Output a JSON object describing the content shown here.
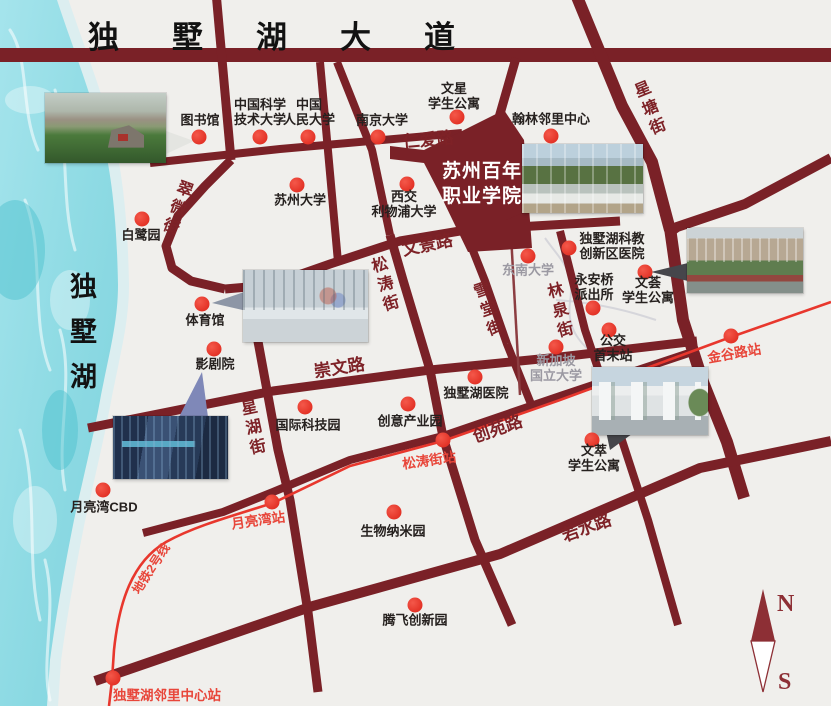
{
  "map": {
    "title": "苏州百年职业学院周边交通示意图",
    "colors": {
      "background": "#f0efec",
      "road": "#7a2127",
      "road_minor": "#8c3d41",
      "metro": "#e8372d",
      "dot": "#dc2318",
      "station_text": "#e8463a",
      "road_label_text": "#7e2227",
      "poi_text": "#26211f",
      "poi_text_gray": "#9b99a2",
      "lake_water": "#8fdbe4",
      "lake_shore": "#dceef0",
      "compass": "#8d2f35"
    },
    "avenue": {
      "text": "独墅湖大道"
    },
    "lake": {
      "label": "独墅湖",
      "halo_path": "M57,0 C70,40 90,90 103,140 C113,180 117,230 118,285 C118,320 110,350 101,395 C95,430 85,470 74,520 C65,565 56,615 50,660 L47,706",
      "water_path": "M57,0 C70,40 90,90 103,140 C113,180 117,230 118,285 C118,320 110,350 101,395 C95,430 85,470 74,520 C65,565 56,615 50,660 L47,706 L0,706 L0,0 Z",
      "streaks": [
        "M10,30 C30,60 20,110 38,150",
        "M55,90 C70,140 60,200 75,250",
        "M25,200 C45,250 30,320 50,370",
        "M60,330 C75,380 55,440 65,490",
        "M20,430 C40,490 25,560 40,620",
        "M45,560 C58,610 40,660 50,700"
      ],
      "light_patches": [
        [
          30,
          100,
          25,
          14
        ],
        [
          70,
          300,
          20,
          30
        ],
        [
          35,
          520,
          22,
          34
        ]
      ],
      "dark_patches": [
        [
          15,
          250,
          30,
          50
        ],
        [
          60,
          430,
          18,
          40
        ]
      ]
    },
    "roads": [
      {
        "name": "dushuhu-avenue-road",
        "w": 14,
        "pts": [
          [
            0,
            55
          ],
          [
            831,
            55
          ]
        ]
      },
      {
        "name": "xingtang-street-north",
        "w": 12,
        "pts": [
          [
            575,
            -8
          ],
          [
            622,
            106
          ],
          [
            652,
            162
          ],
          [
            670,
            230
          ]
        ]
      },
      {
        "name": "wenjing-road-east",
        "w": 10,
        "pts": [
          [
            831,
            158
          ],
          [
            745,
            204
          ],
          [
            677,
            227
          ],
          [
            670,
            232
          ]
        ]
      },
      {
        "name": "xingtang-street-south",
        "w": 12,
        "pts": [
          [
            670,
            228
          ],
          [
            683,
            320
          ],
          [
            703,
            382
          ],
          [
            727,
            442
          ],
          [
            744,
            498
          ]
        ]
      },
      {
        "name": "library-street",
        "w": 9,
        "pts": [
          [
            216,
            -8
          ],
          [
            231,
            160
          ]
        ]
      },
      {
        "name": "cuiwei-street-road",
        "w": 9,
        "pts": [
          [
            231,
            160
          ],
          [
            205,
            186
          ],
          [
            178,
            216
          ],
          [
            166,
            246
          ],
          [
            172,
            268
          ],
          [
            191,
            281
          ],
          [
            225,
            289
          ]
        ]
      },
      {
        "name": "wenjing-road",
        "w": 9,
        "pts": [
          [
            225,
            289
          ],
          [
            270,
            285
          ],
          [
            330,
            264
          ],
          [
            400,
            241
          ],
          [
            466,
            230
          ],
          [
            620,
            221
          ]
        ]
      },
      {
        "name": "campus-street-west",
        "w": 8,
        "pts": [
          [
            320,
            62
          ],
          [
            338,
            262
          ]
        ]
      },
      {
        "name": "campus-street-east",
        "w": 8,
        "pts": [
          [
            337,
            62
          ],
          [
            372,
            150
          ],
          [
            390,
            235
          ]
        ]
      },
      {
        "name": "songtao-street-road",
        "w": 9,
        "pts": [
          [
            390,
            235
          ],
          [
            403,
            280
          ],
          [
            430,
            370
          ],
          [
            443,
            437
          ],
          [
            475,
            540
          ],
          [
            512,
            625
          ]
        ]
      },
      {
        "name": "renai-road",
        "w": 8,
        "pts": [
          [
            150,
            163
          ],
          [
            280,
            149
          ],
          [
            462,
            133
          ]
        ]
      },
      {
        "name": "college-link-road",
        "w": 9,
        "pts": [
          [
            496,
            128
          ],
          [
            516,
            58
          ]
        ]
      },
      {
        "name": "chongwen-road",
        "w": 9,
        "pts": [
          [
            88,
            428
          ],
          [
            273,
            391
          ],
          [
            430,
            370
          ],
          [
            560,
            357
          ],
          [
            697,
            341
          ]
        ]
      },
      {
        "name": "chuangyuan-road",
        "w": 8,
        "pts": [
          [
            143,
            533
          ],
          [
            223,
            512
          ],
          [
            273,
            492
          ],
          [
            350,
            460
          ],
          [
            443,
            436
          ],
          [
            560,
            396
          ],
          [
            692,
            352
          ]
        ]
      },
      {
        "name": "ruoshui-road",
        "w": 10,
        "pts": [
          [
            95,
            681
          ],
          [
            313,
            606
          ],
          [
            500,
            554
          ],
          [
            700,
            468
          ],
          [
            831,
            441
          ]
        ]
      },
      {
        "name": "xinghu-street-road",
        "w": 9,
        "pts": [
          [
            257,
            336
          ],
          [
            278,
            450
          ],
          [
            290,
            500
          ],
          [
            308,
            612
          ],
          [
            318,
            692
          ]
        ]
      },
      {
        "name": "xuetang-street-road",
        "w": 8,
        "pts": [
          [
            464,
            228
          ],
          [
            485,
            281
          ],
          [
            507,
            344
          ],
          [
            531,
            404
          ]
        ]
      },
      {
        "name": "linquan-street-road",
        "w": 8,
        "pts": [
          [
            560,
            231
          ],
          [
            585,
            330
          ],
          [
            618,
            428
          ],
          [
            648,
            520
          ],
          [
            678,
            625
          ]
        ]
      },
      {
        "name": "minor-lane",
        "w": 2.5,
        "pts": [
          [
            511,
            235
          ],
          [
            520,
            395
          ]
        ]
      }
    ],
    "canals": [
      "M545,238 C562,262 575,270 570,302 C566,332 584,346 596,356",
      "M556,300 C600,303 632,312 656,320"
    ],
    "metro": {
      "label": "地铁2号线",
      "label_pos": [
        150,
        568
      ],
      "label_rotate": -57,
      "path": "M831,302 L731,337 L560,400 L443,441 L350,466 L273,503 C225,518 193,527 166,542 C132,562 119,602 114,650 L112,680 L109,706"
    },
    "stations": [
      {
        "label": "金谷路站",
        "dot": [
          731,
          336
        ],
        "pos": [
          734,
          352
        ],
        "rotate": -10
      },
      {
        "label": "松涛街站",
        "dot": [
          443,
          440
        ],
        "pos": [
          429,
          459
        ],
        "rotate": -8
      },
      {
        "label": "月亮湾站",
        "dot": [
          272,
          502
        ],
        "pos": [
          258,
          519
        ],
        "rotate": -8
      },
      {
        "label": "独墅湖邻里中心站",
        "dot": [
          113,
          678
        ],
        "pos": [
          167,
          694
        ],
        "rotate": 0
      }
    ],
    "college": {
      "label": "苏州百年\n职业学院",
      "polygon": "390,146 424,150 504,110 524,140 532,248 468,252 440,194 424,163 390,159"
    },
    "road_labels": [
      {
        "text": "仁爱路",
        "x": 428,
        "y": 138,
        "rotate": -5,
        "vertical": false
      },
      {
        "text": "文景路",
        "x": 427,
        "y": 243,
        "rotate": -12,
        "vertical": false
      },
      {
        "text": "崇文路",
        "x": 339,
        "y": 366,
        "rotate": -9,
        "vertical": false
      },
      {
        "text": "创苑路",
        "x": 497,
        "y": 427,
        "rotate": -19,
        "vertical": false
      },
      {
        "text": "若水路",
        "x": 586,
        "y": 526,
        "rotate": -20,
        "vertical": false
      },
      {
        "text": "翠微街",
        "x": 175,
        "y": 208,
        "rotate": 20,
        "vertical": true
      },
      {
        "text": "星塘街",
        "x": 648,
        "y": 110,
        "rotate": -22,
        "vertical": true
      },
      {
        "text": "松涛街",
        "x": 383,
        "y": 286,
        "rotate": -16,
        "vertical": true
      },
      {
        "text": "雪堂街",
        "x": 486,
        "y": 311,
        "rotate": -19,
        "vertical": true
      },
      {
        "text": "林泉街",
        "x": 558,
        "y": 312,
        "rotate": -14,
        "vertical": true
      },
      {
        "text": "星湖街",
        "x": 251,
        "y": 429,
        "rotate": -12,
        "vertical": true
      }
    ],
    "pois": [
      {
        "label": "图书馆",
        "pos": [
          200,
          121
        ],
        "dot": [
          199,
          137
        ],
        "gray": false
      },
      {
        "label": "中国科学\n技术大学",
        "pos": [
          260,
          113
        ],
        "dot": [
          260,
          137
        ],
        "gray": false
      },
      {
        "label": "中国\n人民大学",
        "pos": [
          309,
          113
        ],
        "dot": [
          308,
          137
        ],
        "gray": false
      },
      {
        "label": "南京大学",
        "pos": [
          382,
          121
        ],
        "dot": [
          378,
          137
        ],
        "gray": false
      },
      {
        "label": "白鹭园",
        "pos": [
          141,
          236
        ],
        "dot": [
          142,
          219
        ],
        "gray": false
      },
      {
        "label": "苏州大学",
        "pos": [
          300,
          201
        ],
        "dot": [
          297,
          185
        ],
        "gray": false
      },
      {
        "label": "西交\n利物浦大学",
        "pos": [
          404,
          205
        ],
        "dot": [
          407,
          184
        ],
        "gray": false
      },
      {
        "label": "文星\n学生公寓",
        "pos": [
          454,
          97
        ],
        "dot": [
          457,
          117
        ],
        "gray": false
      },
      {
        "label": "翰林邻里中心",
        "pos": [
          551,
          120
        ],
        "dot": [
          551,
          136
        ],
        "gray": false
      },
      {
        "label": "体育馆",
        "pos": [
          205,
          321
        ],
        "dot": [
          202,
          304
        ],
        "gray": false
      },
      {
        "label": "影剧院",
        "pos": [
          215,
          365
        ],
        "dot": [
          214,
          349
        ],
        "gray": false
      },
      {
        "label": "国际科技园",
        "pos": [
          308,
          426
        ],
        "dot": [
          305,
          407
        ],
        "gray": false
      },
      {
        "label": "创意产业园",
        "pos": [
          410,
          422
        ],
        "dot": [
          408,
          404
        ],
        "gray": false
      },
      {
        "label": "独墅湖医院",
        "pos": [
          476,
          394
        ],
        "dot": [
          475,
          377
        ],
        "gray": false
      },
      {
        "label": "东南大学",
        "pos": [
          528,
          271
        ],
        "dot": [
          528,
          256
        ],
        "gray": true
      },
      {
        "label": "独墅湖科教\n创新区医院",
        "pos": [
          612,
          247
        ],
        "dot": [
          569,
          248
        ],
        "gray": false
      },
      {
        "label": "永安桥\n派出所",
        "pos": [
          594,
          288
        ],
        "dot": [
          593,
          308
        ],
        "gray": false
      },
      {
        "label": "文荟\n学生公寓",
        "pos": [
          648,
          291
        ],
        "dot": [
          645,
          272
        ],
        "gray": false
      },
      {
        "label": "公交\n首末站",
        "pos": [
          613,
          349
        ],
        "dot": [
          609,
          330
        ],
        "gray": false
      },
      {
        "label": "新加坡\n国立大学",
        "pos": [
          556,
          369
        ],
        "dot": [
          556,
          347
        ],
        "gray": true
      },
      {
        "label": "文萃\n学生公寓",
        "pos": [
          594,
          459
        ],
        "dot": [
          592,
          440
        ],
        "gray": false
      },
      {
        "label": "月亮湾CBD",
        "pos": [
          104,
          508
        ],
        "dot": [
          103,
          490
        ],
        "gray": false
      },
      {
        "label": "生物纳米园",
        "pos": [
          393,
          532
        ],
        "dot": [
          394,
          512
        ],
        "gray": false
      },
      {
        "label": "腾飞创新园",
        "pos": [
          415,
          621
        ],
        "dot": [
          415,
          605
        ],
        "gray": false
      }
    ],
    "photos": [
      {
        "name": "photo-lake-campus",
        "cls": "ph-a",
        "x": 45,
        "y": 93,
        "w": 121,
        "h": 70
      },
      {
        "name": "photo-college-campus",
        "cls": "ph-b",
        "x": 522,
        "y": 144,
        "w": 121,
        "h": 69
      },
      {
        "name": "photo-student-apartments",
        "cls": "ph-c",
        "x": 687,
        "y": 228,
        "w": 116,
        "h": 65
      },
      {
        "name": "photo-gymnasium",
        "cls": "ph-d",
        "x": 243,
        "y": 270,
        "w": 125,
        "h": 72
      },
      {
        "name": "photo-moon-bay-cbd",
        "cls": "ph-e",
        "x": 113,
        "y": 416,
        "w": 115,
        "h": 63
      },
      {
        "name": "photo-campus-gate",
        "cls": "ph-f",
        "x": 592,
        "y": 367,
        "w": 116,
        "h": 68
      }
    ],
    "tails": [
      {
        "name": "college-callout-tail",
        "fill": "#7a2127",
        "pts": "506,196 530,210 506,220"
      },
      {
        "name": "photo-a-callout-tail",
        "fill": "#e4e5e1",
        "pts": "166,131 194,141 166,154"
      },
      {
        "name": "photo-d-callout-tail",
        "fill": "#8d96a6",
        "pts": "247,291 212,303 247,311"
      },
      {
        "name": "photo-e-callout-tail",
        "fill": "#7f88b8",
        "pts": "202,372 179,417 208,417"
      },
      {
        "name": "photo-c-callout-tail",
        "fill": "#46464b",
        "pts": "688,263 651,272 688,281"
      },
      {
        "name": "photo-f-callout-tail",
        "fill": "#46464b",
        "pts": "606,431 636,431 610,450"
      }
    ],
    "compass": {
      "n": "N",
      "s": "S",
      "cx": 763,
      "top": 589,
      "mid": 641,
      "bottom": 692
    }
  }
}
